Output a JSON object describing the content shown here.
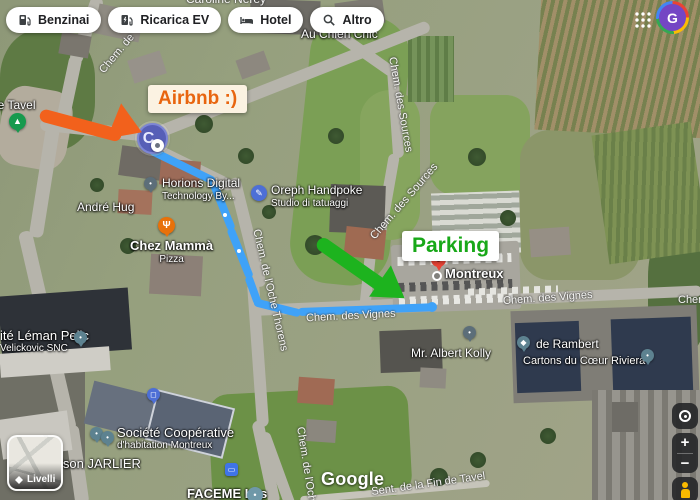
{
  "toolbar": {
    "chips": [
      {
        "label": "Benzinai"
      },
      {
        "label": "Ricarica EV"
      },
      {
        "label": "Hotel"
      },
      {
        "label": "Altro"
      }
    ]
  },
  "account": {
    "avatar_initial": "G"
  },
  "annotations": {
    "airbnb_label": "Airbnb :)",
    "parking_label": "Parking",
    "colors": {
      "arrow_orange": "#f2611c",
      "arrow_green": "#1db31e",
      "route_blue": "#3fa2f8",
      "airbnb_text": "#e8650f",
      "parking_text": "#18a818"
    }
  },
  "map": {
    "saved_marker_initial": "C",
    "attribution": "Google",
    "labels": [
      {
        "name": "street-label",
        "text": "Caroline Nerey",
        "cls": "street",
        "css": "left:186px;top:-7px;font-size:12px"
      },
      {
        "name": "place-label",
        "text": "Au Chien Chic",
        "cls": "place",
        "css": "left:301px;top:28px"
      },
      {
        "name": "street-label",
        "text": "Chem. des Sources",
        "cls": "street",
        "css": "left:398px;top:56px;transform:rotate(80deg);transform-origin:0 0"
      },
      {
        "name": "street-label",
        "text": "Chem. des Sources",
        "cls": "street",
        "css": "left:368px;top:234px;transform:rotate(-49deg);transform-origin:0 0"
      },
      {
        "name": "place-label",
        "text": "de Tavel",
        "cls": "place",
        "css": "left:-9px;top:99px"
      },
      {
        "name": "place-label",
        "text": "Horions Digital",
        "sub": "Technology By...",
        "cls": "place",
        "css": "left:162px;top:177px"
      },
      {
        "name": "place-label",
        "text": "Oreph Handpoke",
        "sub": "Studio di tatuaggi",
        "cls": "place",
        "css": "left:271px;top:184px"
      },
      {
        "name": "place-label",
        "text": "André Hug",
        "cls": "place",
        "css": "left:77px;top:201px"
      },
      {
        "name": "place-label",
        "text": "Chez Mammà",
        "sub": "Pizza",
        "cls": "lg ctr",
        "css": "left:130px;top:239px"
      },
      {
        "name": "place-label",
        "text": "Montreux",
        "cls": "lg",
        "css": "left:445px;top:267px"
      },
      {
        "name": "street-label",
        "text": "Chem. des Vignes",
        "cls": "street",
        "css": "left:306px;top:310px;transform:rotate(-3deg)"
      },
      {
        "name": "street-label",
        "text": "Chem. des Vignes",
        "cls": "street",
        "css": "left:503px;top:292px;transform:rotate(-4deg)"
      },
      {
        "name": "street-label",
        "text": "Chem. des Vignes",
        "cls": "street",
        "css": "left:678px;top:294px"
      },
      {
        "name": "place-label",
        "text": "Mr. Albert Kolly",
        "cls": "place",
        "css": "left:411px;top:347px"
      },
      {
        "name": "place-label",
        "text": "de Rambert",
        "cls": "place",
        "css": "left:536px;top:338px"
      },
      {
        "name": "place-label",
        "text": "Cartons du Cœur Riviera",
        "cls": "sm",
        "css": "left:523px;top:355px"
      },
      {
        "name": "place-label",
        "text": "ité Léman Pejic",
        "sub": "Velickovic SNC",
        "cls": "place",
        "css": "left:0px;top:329px;font-size:13px"
      },
      {
        "name": "place-label",
        "text": "Société Coopérative",
        "sub": "d'habitation Montreux",
        "cls": "place",
        "css": "left:117px;top:426px;font-size:13px"
      },
      {
        "name": "place-label",
        "text": "ison JARLIER",
        "cls": "place",
        "css": "left:60px;top:457px;font-size:13px"
      },
      {
        "name": "place-label",
        "text": "FACEME Les",
        "cls": "lg",
        "css": "left:187px;top:487px"
      },
      {
        "name": "street-label",
        "text": "Chem. de l'Oche Thorens",
        "cls": "street",
        "css": "left:262px;top:228px;transform:rotate(77deg);transform-origin:0 0"
      },
      {
        "name": "street-label",
        "text": "Chem. de l'Oche",
        "cls": "street",
        "css": "left:306px;top:426px;transform:rotate(81deg);transform-origin:0 0"
      },
      {
        "name": "street-label",
        "text": "Chem. de",
        "cls": "street",
        "css": "left:97px;top:68px;transform:rotate(-50deg);transform-origin:0 0"
      },
      {
        "name": "street-label",
        "text": "Sent. de la Fin de Tavel",
        "cls": "street",
        "css": "left:371px;top:478px;transform:rotate(-8deg)"
      }
    ],
    "pins": [
      {
        "name": "place-pin",
        "cls": "slate",
        "glyph": "•",
        "css": "left:144px;top:177px"
      },
      {
        "name": "tattoo-studio-pin",
        "cls": "badge blue",
        "glyph": "✎",
        "css": "left:251px;top:185px"
      },
      {
        "name": "restaurant-pin",
        "cls": "orange",
        "glyph": "Ψ",
        "css": "left:158px;top:217px"
      },
      {
        "name": "park-pin",
        "cls": "green",
        "glyph": "▲",
        "css": "left:9px;top:113px"
      },
      {
        "name": "place-pin",
        "cls": "slate",
        "glyph": "•",
        "css": "left:463px;top:326px"
      },
      {
        "name": "school-pin",
        "cls": "teal",
        "glyph": "◆",
        "css": "left:517px;top:336px"
      },
      {
        "name": "place-pin",
        "cls": "teal",
        "glyph": "•",
        "css": "left:641px;top:349px"
      },
      {
        "name": "place-pin",
        "cls": "teal",
        "glyph": "•",
        "css": "left:74px;top:331px"
      },
      {
        "name": "place-pin",
        "cls": "teal",
        "glyph": "•",
        "css": "left:90px;top:427px"
      },
      {
        "name": "place-pin",
        "cls": "teal",
        "glyph": "•",
        "css": "left:101px;top:431px"
      },
      {
        "name": "shopping-pin",
        "cls": "blue",
        "glyph": "◻",
        "css": "left:147px;top:388px"
      },
      {
        "name": "bus-stop-icon",
        "cls": "square",
        "glyph": "▭",
        "css": "left:225px;top:463px"
      },
      {
        "name": "place-icon",
        "cls": "badge sea",
        "glyph": "•",
        "css": "left:247px;top:487px"
      }
    ]
  },
  "controls": {
    "layers_label": "Livelli",
    "zoom_in": "+",
    "zoom_out": "−"
  }
}
